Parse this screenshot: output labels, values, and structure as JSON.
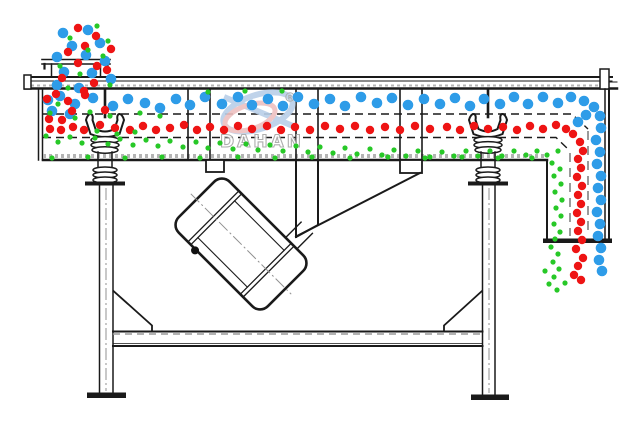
{
  "watermark": {
    "brand_text": "DAHAN",
    "registered_mark": "R"
  },
  "colors": {
    "line": "#1a1a1a",
    "coarse_particle": "#2e9ce8",
    "medium_particle": "#ee1414",
    "fine_particle": "#27c827",
    "watermark_blue": "#b9cfe8",
    "watermark_pink": "#eec0c0",
    "watermark_gray": "#a6a6a6"
  },
  "particles": {
    "coarse": {
      "name": "coarse-particles",
      "color": "#2e9ce8",
      "radius": 5.3,
      "points": [
        [
          63,
          33
        ],
        [
          88,
          30
        ],
        [
          100,
          43
        ],
        [
          72,
          46
        ],
        [
          57,
          57
        ],
        [
          86,
          55
        ],
        [
          105,
          61
        ],
        [
          64,
          72
        ],
        [
          92,
          73
        ],
        [
          111,
          79
        ],
        [
          57,
          85
        ],
        [
          79,
          88
        ],
        [
          48,
          100
        ],
        [
          60,
          96
        ],
        [
          75,
          104
        ],
        [
          93,
          98
        ],
        [
          113,
          106
        ],
        [
          128,
          99
        ],
        [
          145,
          103
        ],
        [
          160,
          108
        ],
        [
          176,
          99
        ],
        [
          190,
          105
        ],
        [
          205,
          97
        ],
        [
          222,
          104
        ],
        [
          238,
          97
        ],
        [
          252,
          105
        ],
        [
          268,
          99
        ],
        [
          283,
          106
        ],
        [
          298,
          97
        ],
        [
          314,
          104
        ],
        [
          330,
          99
        ],
        [
          345,
          106
        ],
        [
          361,
          97
        ],
        [
          377,
          103
        ],
        [
          392,
          98
        ],
        [
          408,
          105
        ],
        [
          424,
          99
        ],
        [
          440,
          104
        ],
        [
          455,
          98
        ],
        [
          470,
          106
        ],
        [
          484,
          99
        ],
        [
          500,
          104
        ],
        [
          514,
          97
        ],
        [
          528,
          104
        ],
        [
          543,
          97
        ],
        [
          558,
          103
        ],
        [
          571,
          97
        ],
        [
          584,
          101
        ],
        [
          52,
          111
        ],
        [
          70,
          114
        ],
        [
          594,
          107
        ],
        [
          600,
          116
        ],
        [
          586,
          115
        ],
        [
          578,
          122
        ],
        [
          601,
          128
        ],
        [
          596,
          140
        ],
        [
          600,
          152
        ],
        [
          597,
          164
        ],
        [
          601,
          176
        ],
        [
          598,
          188
        ],
        [
          601,
          200
        ],
        [
          597,
          212
        ],
        [
          600,
          224
        ],
        [
          598,
          236
        ],
        [
          601,
          248
        ],
        [
          599,
          260
        ],
        [
          602,
          271
        ]
      ]
    },
    "medium": {
      "name": "medium-particles",
      "color": "#ee1414",
      "radius": 4.2,
      "points": [
        [
          78,
          28
        ],
        [
          96,
          36
        ],
        [
          85,
          46
        ],
        [
          111,
          49
        ],
        [
          68,
          52
        ],
        [
          97,
          66
        ],
        [
          78,
          63
        ],
        [
          107,
          70
        ],
        [
          62,
          78
        ],
        [
          94,
          83
        ],
        [
          84,
          91
        ],
        [
          47,
          99
        ],
        [
          56,
          94
        ],
        [
          68,
          101
        ],
        [
          85,
          95
        ],
        [
          72,
          111
        ],
        [
          49,
          119
        ],
        [
          62,
          120
        ],
        [
          105,
          110
        ],
        [
          50,
          129
        ],
        [
          61,
          130
        ],
        [
          73,
          127
        ],
        [
          84,
          130
        ],
        [
          100,
          125
        ],
        [
          115,
          128
        ],
        [
          130,
          130
        ],
        [
          143,
          126
        ],
        [
          156,
          130
        ],
        [
          170,
          128
        ],
        [
          184,
          125
        ],
        [
          197,
          130
        ],
        [
          210,
          127
        ],
        [
          224,
          130
        ],
        [
          238,
          126
        ],
        [
          252,
          129
        ],
        [
          267,
          126
        ],
        [
          281,
          130
        ],
        [
          295,
          127
        ],
        [
          310,
          130
        ],
        [
          325,
          126
        ],
        [
          340,
          129
        ],
        [
          355,
          126
        ],
        [
          370,
          130
        ],
        [
          385,
          127
        ],
        [
          400,
          130
        ],
        [
          415,
          126
        ],
        [
          430,
          129
        ],
        [
          447,
          127
        ],
        [
          460,
          130
        ],
        [
          474,
          126
        ],
        [
          488,
          129
        ],
        [
          503,
          127
        ],
        [
          517,
          130
        ],
        [
          530,
          126
        ],
        [
          543,
          129
        ],
        [
          556,
          125
        ],
        [
          566,
          129
        ],
        [
          573,
          134
        ],
        [
          580,
          142
        ],
        [
          583,
          151
        ],
        [
          578,
          159
        ],
        [
          581,
          168
        ],
        [
          577,
          177
        ],
        [
          582,
          186
        ],
        [
          578,
          195
        ],
        [
          581,
          204
        ],
        [
          577,
          213
        ],
        [
          581,
          222
        ],
        [
          578,
          231
        ],
        [
          582,
          240
        ],
        [
          576,
          249
        ],
        [
          583,
          258
        ],
        [
          578,
          266
        ],
        [
          574,
          275
        ],
        [
          581,
          280
        ]
      ]
    },
    "fine": {
      "name": "fine-particles",
      "color": "#27c827",
      "radius": 2.6,
      "points": [
        [
          97,
          26
        ],
        [
          70,
          38
        ],
        [
          108,
          41
        ],
        [
          88,
          50
        ],
        [
          60,
          66
        ],
        [
          103,
          56
        ],
        [
          80,
          74
        ],
        [
          110,
          85
        ],
        [
          68,
          88
        ],
        [
          58,
          104
        ],
        [
          50,
          113
        ],
        [
          75,
          118
        ],
        [
          90,
          112
        ],
        [
          110,
          116
        ],
        [
          140,
          113
        ],
        [
          160,
          116
        ],
        [
          97,
          131
        ],
        [
          117,
          134
        ],
        [
          135,
          132
        ],
        [
          208,
          92
        ],
        [
          245,
          91
        ],
        [
          282,
          91
        ],
        [
          46,
          136
        ],
        [
          58,
          142
        ],
        [
          70,
          137
        ],
        [
          82,
          143
        ],
        [
          95,
          138
        ],
        [
          108,
          144
        ],
        [
          120,
          139
        ],
        [
          133,
          145
        ],
        [
          146,
          140
        ],
        [
          158,
          146
        ],
        [
          170,
          141
        ],
        [
          183,
          147
        ],
        [
          196,
          142
        ],
        [
          208,
          148
        ],
        [
          220,
          143
        ],
        [
          233,
          149
        ],
        [
          246,
          144
        ],
        [
          258,
          150
        ],
        [
          270,
          145
        ],
        [
          283,
          151
        ],
        [
          296,
          146
        ],
        [
          308,
          152
        ],
        [
          320,
          147
        ],
        [
          333,
          153
        ],
        [
          345,
          148
        ],
        [
          357,
          154
        ],
        [
          370,
          149
        ],
        [
          382,
          155
        ],
        [
          394,
          150
        ],
        [
          406,
          156
        ],
        [
          418,
          151
        ],
        [
          430,
          157
        ],
        [
          442,
          152
        ],
        [
          454,
          156
        ],
        [
          466,
          151
        ],
        [
          478,
          156
        ],
        [
          490,
          151
        ],
        [
          502,
          156
        ],
        [
          514,
          151
        ],
        [
          526,
          155
        ],
        [
          537,
          151
        ],
        [
          547,
          155
        ],
        [
          558,
          151
        ],
        [
          52,
          158
        ],
        [
          88,
          157
        ],
        [
          125,
          158
        ],
        [
          162,
          157
        ],
        [
          200,
          158
        ],
        [
          238,
          157
        ],
        [
          275,
          158
        ],
        [
          312,
          157
        ],
        [
          350,
          158
        ],
        [
          388,
          157
        ],
        [
          425,
          158
        ],
        [
          462,
          157
        ],
        [
          498,
          158
        ],
        [
          532,
          158
        ],
        [
          552,
          163
        ],
        [
          560,
          169
        ],
        [
          554,
          176
        ],
        [
          561,
          184
        ],
        [
          555,
          192
        ],
        [
          562,
          200
        ],
        [
          556,
          208
        ],
        [
          561,
          216
        ],
        [
          554,
          224
        ],
        [
          560,
          232
        ],
        [
          555,
          239
        ],
        [
          551,
          247
        ],
        [
          558,
          254
        ],
        [
          553,
          262
        ],
        [
          559,
          269
        ],
        [
          554,
          277
        ],
        [
          549,
          284
        ],
        [
          557,
          290
        ],
        [
          545,
          271
        ],
        [
          565,
          283
        ]
      ]
    }
  }
}
